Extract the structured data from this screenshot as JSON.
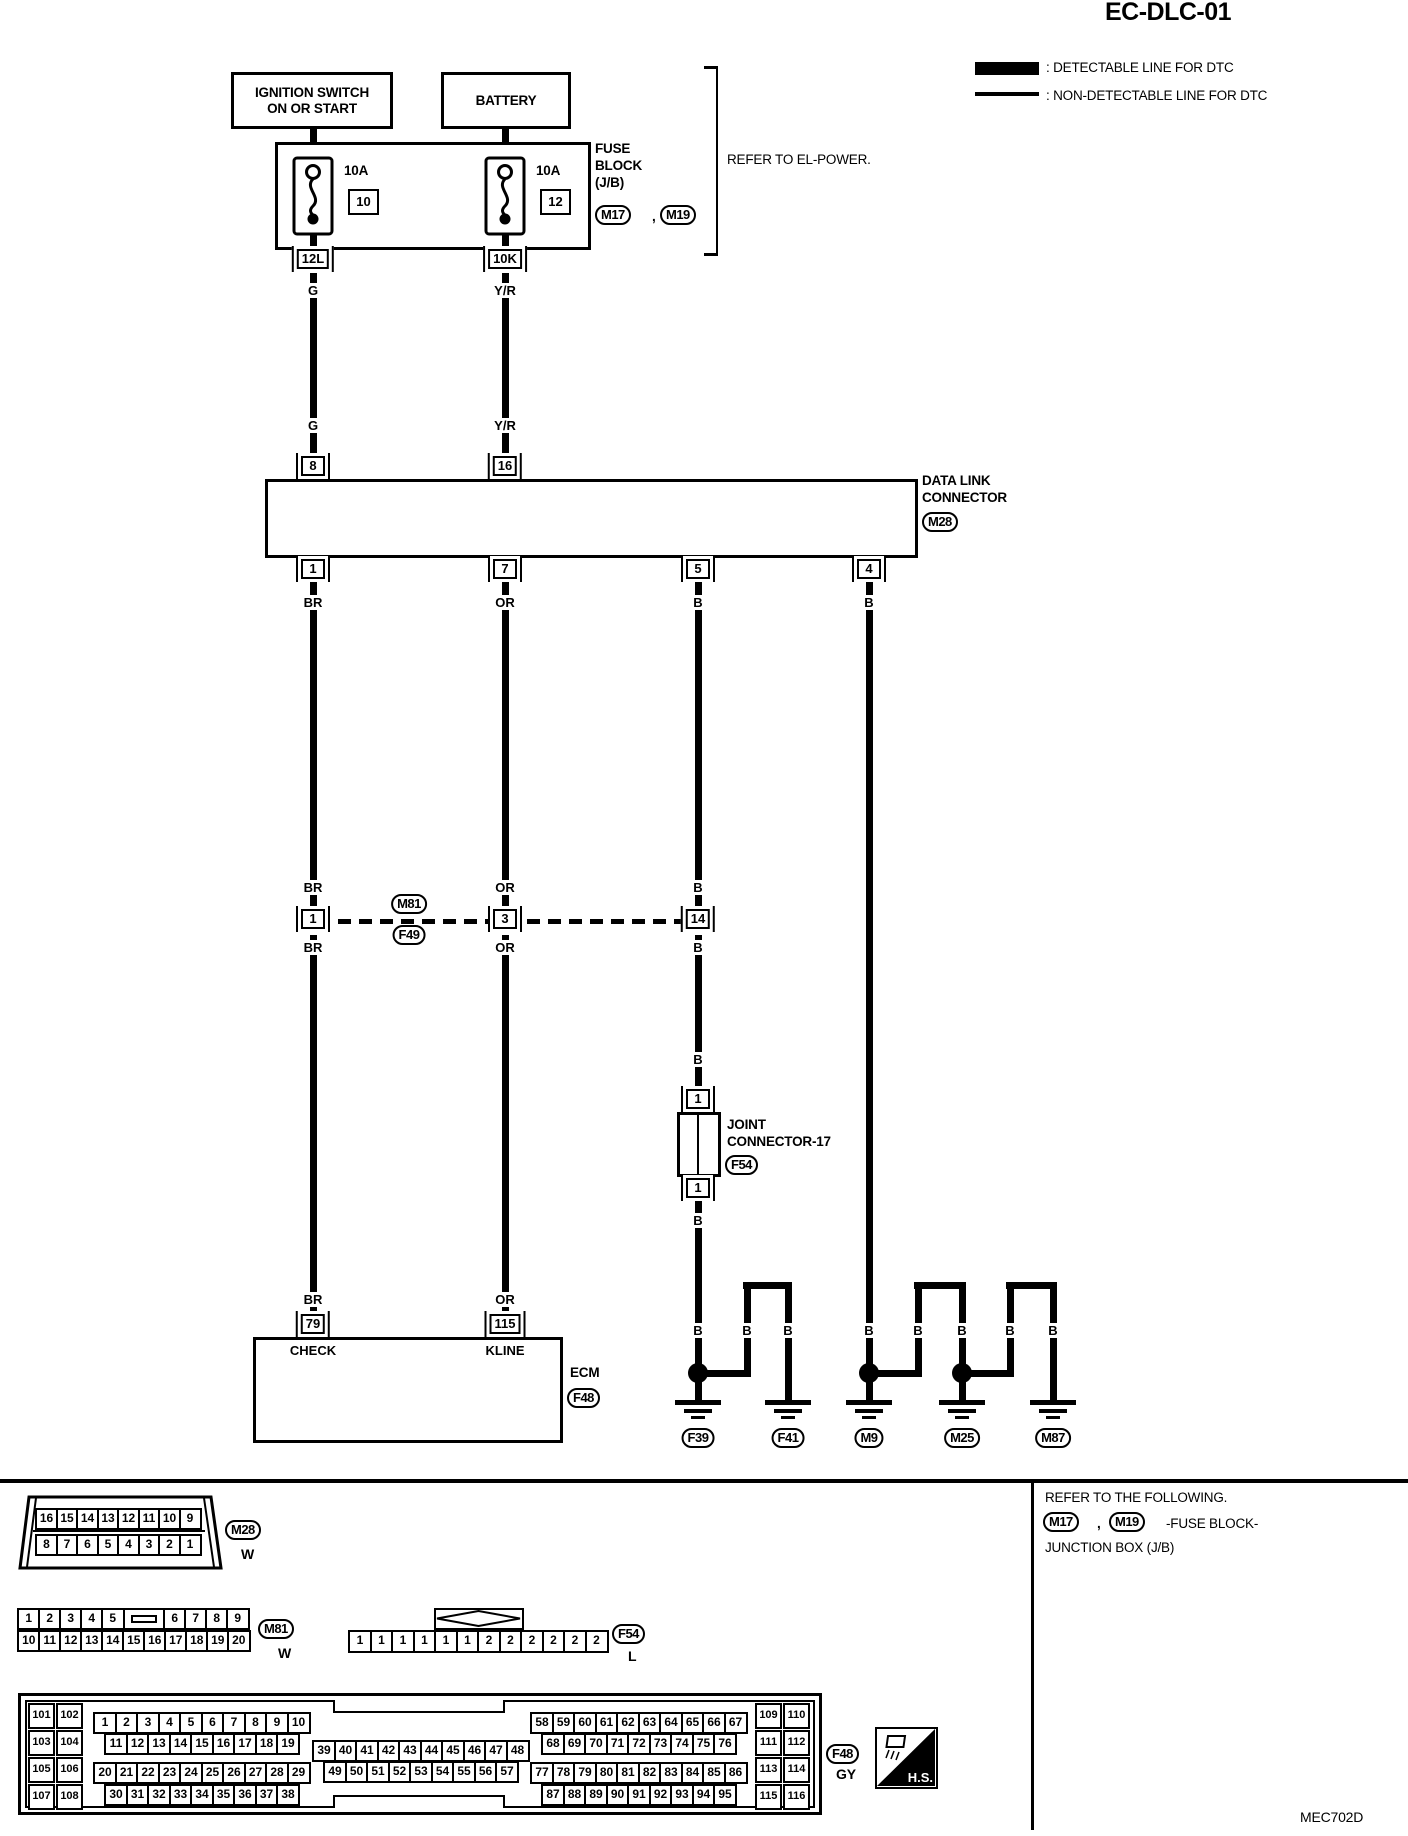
{
  "title": "EC-DLC-01",
  "legend": {
    "detectable": ": DETECTABLE LINE FOR DTC",
    "non_detectable": ": NON-DETECTABLE LINE FOR DTC"
  },
  "power": {
    "ignition_line1": "IGNITION SWITCH",
    "ignition_line2": "ON OR START",
    "battery": "BATTERY",
    "fuse_left": {
      "amp": "10A",
      "num": "10",
      "conn": "12L"
    },
    "fuse_right": {
      "amp": "10A",
      "num": "12",
      "conn": "10K"
    },
    "fuse_block_line1": "FUSE",
    "fuse_block_line2": "BLOCK",
    "fuse_block_line3": "(J/B)",
    "m17": "M17",
    "comma": ",",
    "m19": "M19",
    "refer": "REFER TO EL-POWER."
  },
  "wires": {
    "g": "G",
    "yr": "Y/R",
    "br": "BR",
    "or": "OR",
    "b": "B"
  },
  "dlc": {
    "name_line1": "DATA LINK",
    "name_line2": "CONNECTOR",
    "id": "M28",
    "pin_left_in": "8",
    "pin_right_in": "16",
    "pin_out_1": "1",
    "pin_out_2": "7",
    "pin_out_3": "5",
    "pin_out_4": "4"
  },
  "mid": {
    "id_top": "M81",
    "id_bottom": "F49",
    "pin_1": "1",
    "pin_2": "3",
    "pin_3": "14"
  },
  "joint": {
    "line1": "JOINT",
    "line2": "CONNECTOR-17",
    "id": "F54",
    "pin_top": "1",
    "pin_bottom": "1"
  },
  "ecm": {
    "pin_check": "79",
    "pin_kline": "115",
    "check": "CHECK",
    "kline": "KLINE",
    "label": "ECM",
    "id": "F48"
  },
  "grounds": {
    "g1": "F39",
    "g2": "F41",
    "g3": "M9",
    "g4": "M25",
    "g5": "M87"
  },
  "footer": {
    "m28": {
      "row_top": [
        "16",
        "15",
        "14",
        "13",
        "12",
        "11",
        "10",
        "9"
      ],
      "row_bottom": [
        "8",
        "7",
        "6",
        "5",
        "4",
        "3",
        "2",
        "1"
      ],
      "id": "M28",
      "color": "W"
    },
    "m81": {
      "row_top_left": [
        "1",
        "2",
        "3",
        "4",
        "5"
      ],
      "row_top_right": [
        "6",
        "7",
        "8",
        "9"
      ],
      "row_bottom": [
        "10",
        "11",
        "12",
        "13",
        "14",
        "15",
        "16",
        "17",
        "18",
        "19",
        "20"
      ],
      "id": "M81",
      "color": "W"
    },
    "f54": {
      "cells": [
        "1",
        "1",
        "1",
        "1",
        "1",
        "1",
        "2",
        "2",
        "2",
        "2",
        "2",
        "2"
      ],
      "id": "F54",
      "color": "L"
    },
    "f48": {
      "left_pairs": [
        "101",
        "102",
        "103",
        "104",
        "105",
        "106",
        "107",
        "108"
      ],
      "rows_a": [
        [
          "1",
          "2",
          "3",
          "4",
          "5",
          "6",
          "7",
          "8",
          "9",
          "10"
        ],
        [
          "11",
          "12",
          "13",
          "14",
          "15",
          "16",
          "17",
          "18",
          "19"
        ],
        [
          "20",
          "21",
          "22",
          "23",
          "24",
          "25",
          "26",
          "27",
          "28",
          "29"
        ],
        [
          "30",
          "31",
          "32",
          "33",
          "34",
          "35",
          "36",
          "37",
          "38"
        ]
      ],
      "rows_b": [
        [
          "39",
          "40",
          "41",
          "42",
          "43",
          "44",
          "45",
          "46",
          "47",
          "48"
        ],
        [
          "49",
          "50",
          "51",
          "52",
          "53",
          "54",
          "55",
          "56",
          "57"
        ]
      ],
      "rows_c": [
        [
          "58",
          "59",
          "60",
          "61",
          "62",
          "63",
          "64",
          "65",
          "66",
          "67"
        ],
        [
          "68",
          "69",
          "70",
          "71",
          "72",
          "73",
          "74",
          "75",
          "76"
        ],
        [
          "77",
          "78",
          "79",
          "80",
          "81",
          "82",
          "83",
          "84",
          "85",
          "86"
        ],
        [
          "87",
          "88",
          "89",
          "90",
          "91",
          "92",
          "93",
          "94",
          "95"
        ]
      ],
      "right_pairs": [
        "109",
        "110",
        "111",
        "112",
        "113",
        "114",
        "115",
        "116"
      ],
      "id": "F48",
      "color": "GY",
      "hs": "H.S."
    },
    "refer": {
      "line1": "REFER TO THE FOLLOWING.",
      "m17": "M17",
      "comma": ",",
      "m19": "M19",
      "suffix": "-FUSE BLOCK-",
      "line3": "JUNCTION BOX (J/B)"
    },
    "doc_code": "MEC702D"
  }
}
